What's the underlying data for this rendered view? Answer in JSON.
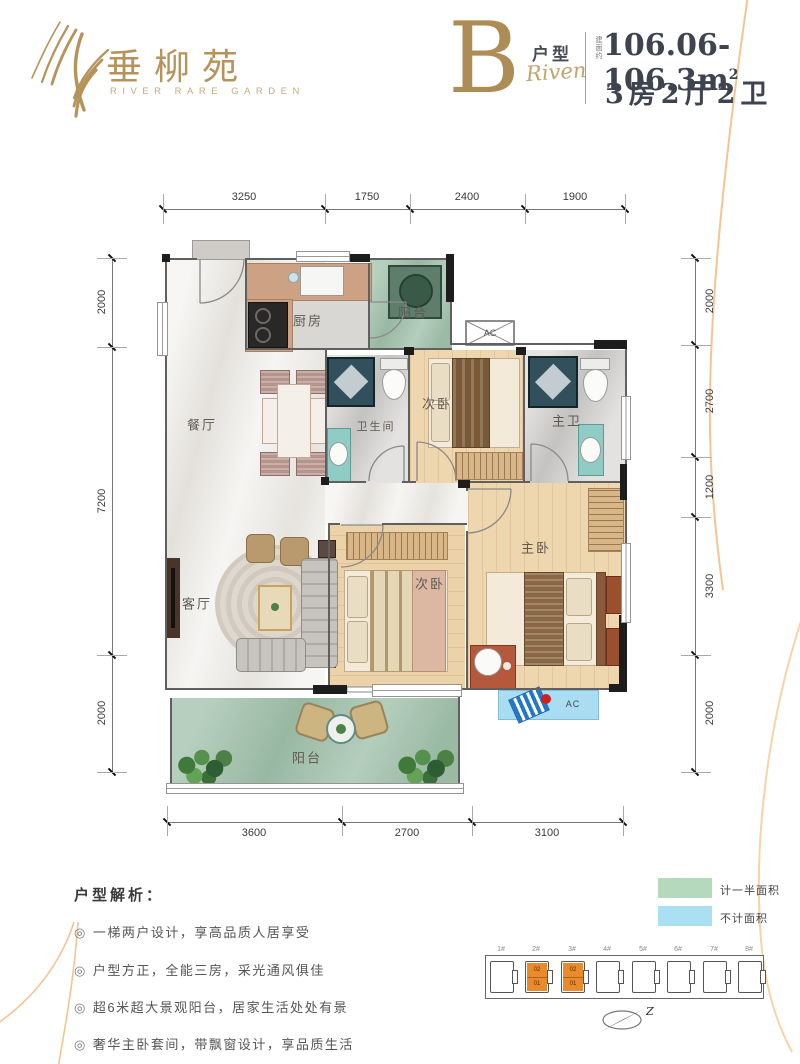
{
  "theme": {
    "gold": "#b6935a",
    "ink": "#3d4450",
    "curve_orange": "#f5c493"
  },
  "header": {
    "brand": "垂柳苑",
    "brand_sub": "RIVER RARE GARDEN",
    "unit_letter": "B",
    "unit_type_label": "户型",
    "unit_script": "Riven",
    "area_prefix": "建面约",
    "area_value": "106.06-106.3m",
    "area_sup": "2",
    "layout_desc": "3房2厅2卫"
  },
  "dimensions": {
    "top": [
      "3250",
      "1750",
      "2400",
      "1900"
    ],
    "bottom": [
      "3600",
      "2700",
      "3100"
    ],
    "left": [
      "2000",
      "7200",
      "2000"
    ],
    "right": [
      "2000",
      "2700",
      "1200",
      "3300",
      "2000"
    ]
  },
  "rooms": {
    "kitchen": "厨房",
    "balcony_top": "阳台",
    "dining": "餐厅",
    "bath": "卫生间",
    "bedroom2_top": "次卧",
    "master_bath": "主卫",
    "living": "客厅",
    "bedroom2_bottom": "次卧",
    "master": "主卧",
    "balcony_bottom": "阳台",
    "ac_top": "AC",
    "ac_bottom": "AC"
  },
  "analysis": {
    "title": "户型解析：",
    "bullet_icon": "◎",
    "items": [
      "一梯两户设计，享高品质人居享受",
      "户型方正，全能三房，采光通风俱佳",
      "超6米超大景观阳台，居家生活处处有景",
      "奢华主卧套间，带飘窗设计，享品质生活"
    ]
  },
  "legend": {
    "items": [
      {
        "label": "计一半面积",
        "color": "#b4d9bc"
      },
      {
        "label": "不计面积",
        "color": "#abdff2"
      }
    ]
  },
  "keyplan": {
    "highlight_color": "#e98a2c",
    "buildings": [
      {
        "label": "1#",
        "highlighted": false
      },
      {
        "label": "2#",
        "highlighted": true,
        "units": [
          "02",
          "01"
        ]
      },
      {
        "label": "3#",
        "highlighted": true,
        "units": [
          "02",
          "01"
        ]
      },
      {
        "label": "4#",
        "highlighted": false
      },
      {
        "label": "5#",
        "highlighted": false
      },
      {
        "label": "6#",
        "highlighted": false
      },
      {
        "label": "7#",
        "highlighted": false
      },
      {
        "label": "8#",
        "highlighted": false
      }
    ],
    "compass_label": "Z"
  }
}
